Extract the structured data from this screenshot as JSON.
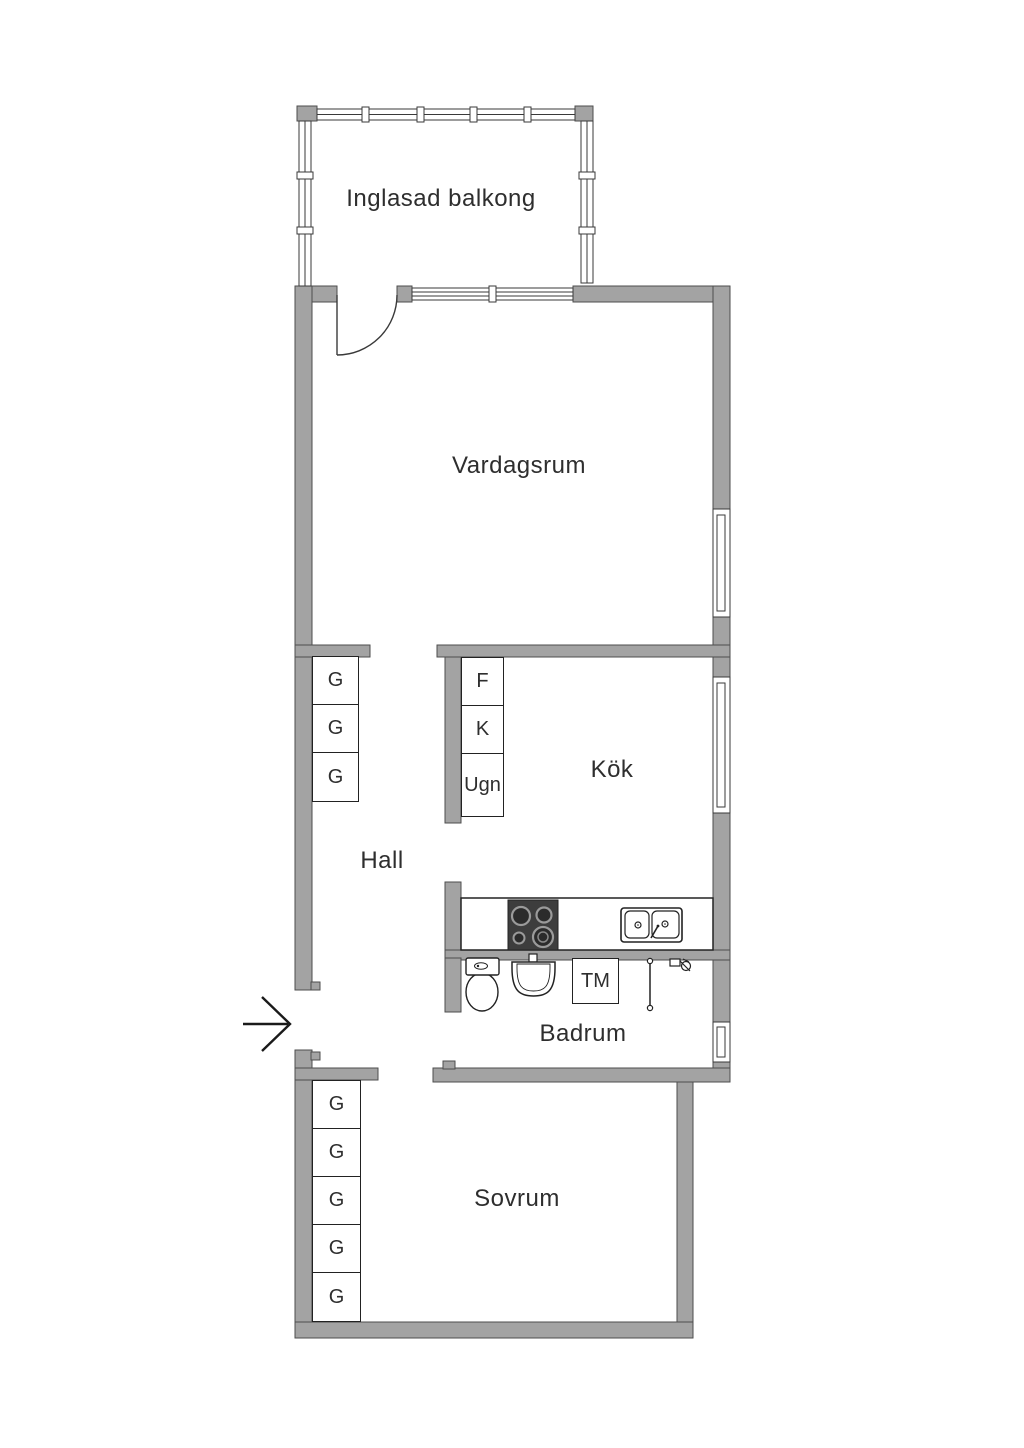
{
  "plan": {
    "rooms": [
      {
        "id": "inglasad-balkong",
        "label": "Inglasad balkong"
      },
      {
        "id": "vardagsrum",
        "label": "Vardagsrum"
      },
      {
        "id": "kok",
        "label": "Kök"
      },
      {
        "id": "hall",
        "label": "Hall"
      },
      {
        "id": "badrum",
        "label": "Badrum"
      },
      {
        "id": "sovrum",
        "label": "Sovrum"
      }
    ],
    "hall_closets": [
      {
        "label": "G"
      },
      {
        "label": "G"
      },
      {
        "label": "G"
      }
    ],
    "bedroom_closets": [
      {
        "label": "G"
      },
      {
        "label": "G"
      },
      {
        "label": "G"
      },
      {
        "label": "G"
      },
      {
        "label": "G"
      }
    ],
    "kitchen_appliances": [
      {
        "label": "F"
      },
      {
        "label": "K"
      },
      {
        "label": "Ugn"
      }
    ],
    "bathroom_appliances": [
      {
        "label": "TM"
      }
    ],
    "icons": [
      "entrance-arrow-icon",
      "door-swing-icon",
      "stove-icon",
      "sink-icon",
      "toilet-icon",
      "washbasin-icon",
      "shower-rail-icon",
      "shower-mixer-icon",
      "window-icon"
    ],
    "colors": {
      "wall_fill": "#a3a3a3",
      "wall_stroke": "#4e4e4e",
      "fixture_line": "#222222",
      "text": "#2e2e2e",
      "background": "#ffffff"
    }
  }
}
